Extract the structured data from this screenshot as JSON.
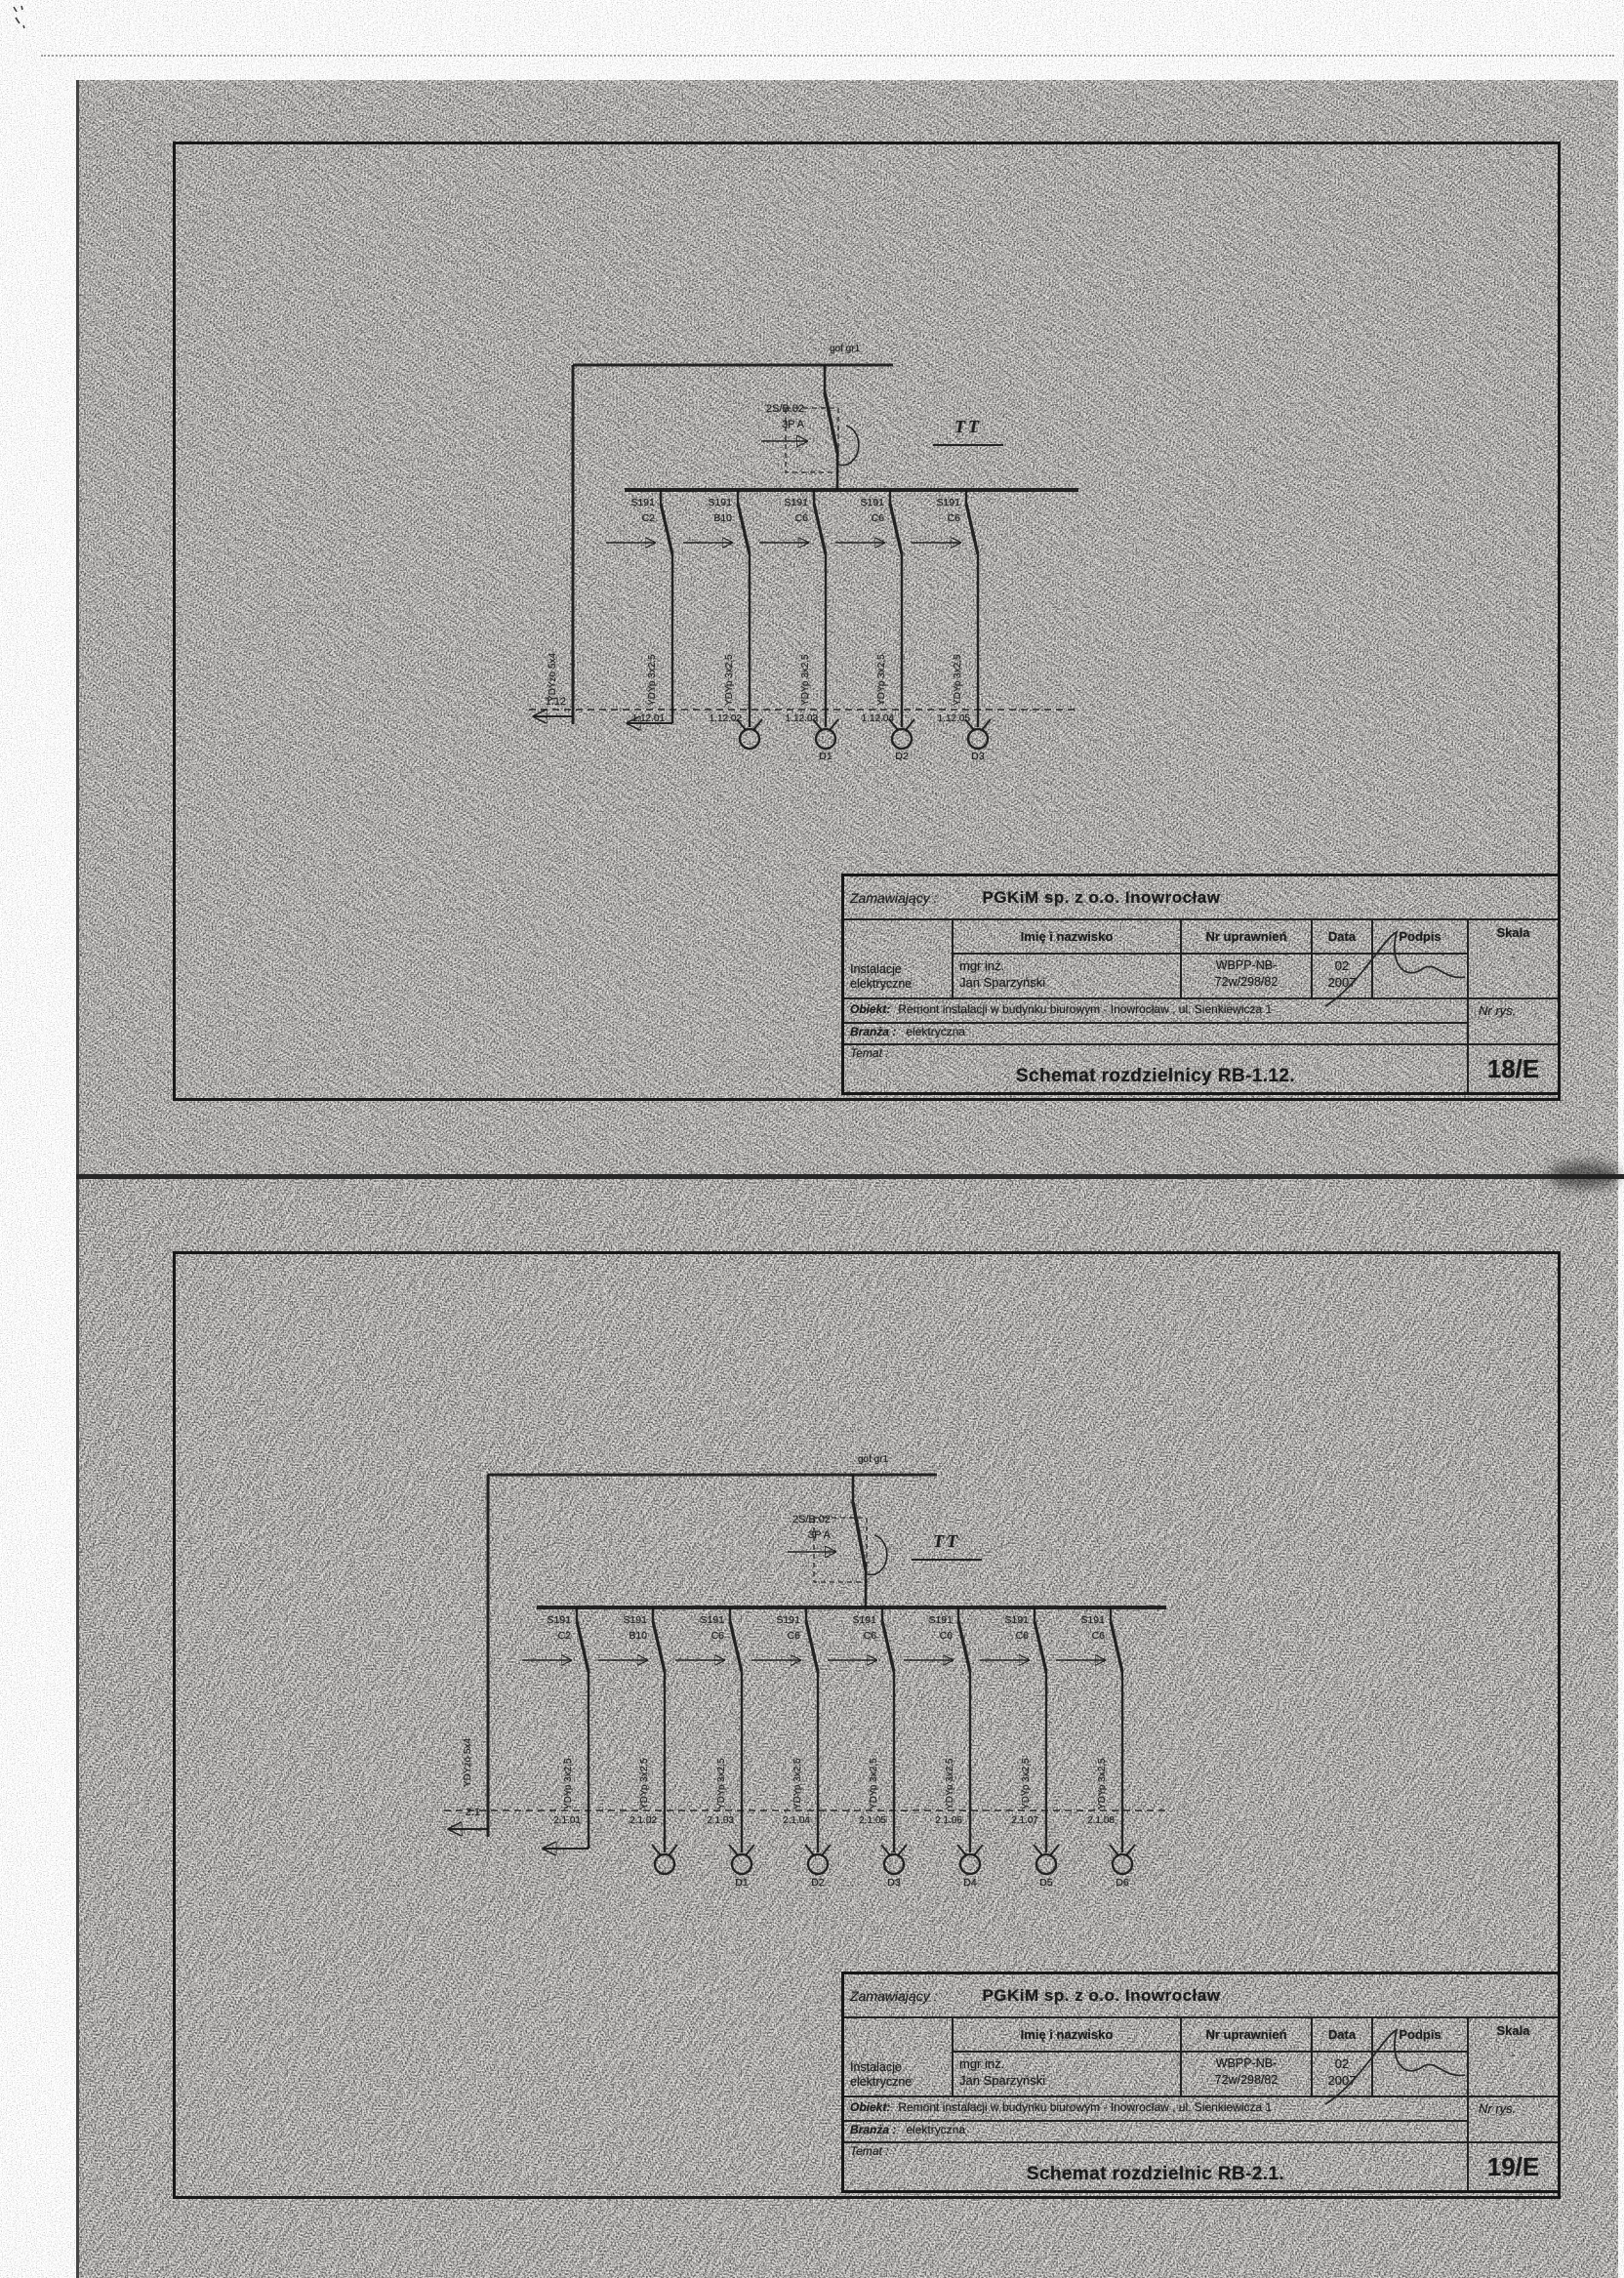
{
  "sheets": [
    {
      "name": "RB-1.12",
      "schematic": {
        "supply_label": "gof gr1",
        "system_label": "TT",
        "main_breaker_line1": "2S/B.02",
        "main_breaker_line2": "3P A",
        "riser_cable": "YDYżo 5x4",
        "riser_circuit": "1.12",
        "branches": [
          {
            "breaker": "S191",
            "rating": "C2",
            "cable": "YDYp 3x2,5",
            "circuit": "1.12.01",
            "load": ""
          },
          {
            "breaker": "S191",
            "rating": "B10",
            "cable": "YDYp 3x2,5",
            "circuit": "1.12.02",
            "load": ""
          },
          {
            "breaker": "S191",
            "rating": "C6",
            "cable": "YDYp 3x2,5",
            "circuit": "1.12.03",
            "load": "D1"
          },
          {
            "breaker": "S191",
            "rating": "C6",
            "cable": "YDYp 3x2,5",
            "circuit": "1.12.04",
            "load": "D2"
          },
          {
            "breaker": "S191",
            "rating": "C6",
            "cable": "YDYp 3x2,5",
            "circuit": "1.12.05",
            "load": "D3"
          }
        ]
      },
      "titleblock": {
        "zamawiajacy_label": "Zamawiający :",
        "zamawiajacy_value": "PGKiM sp. z o.o. Inowrocław",
        "col_name": "Imię i nazwisko",
        "col_license": "Nr uprawnień",
        "col_date": "Data",
        "col_sign": "Podpis",
        "col_scale": "Skala",
        "role_line1": "Instalacje",
        "role_line2": "elektryczne",
        "person_line1": "mgr inż.",
        "person_line2": "Jan Sparzyński",
        "license_line1": "WBPP-NB-",
        "license_line2": "72w/298/82",
        "date_line1": "02",
        "date_line2": "2007",
        "scale_value": "-",
        "obiekt_label": "Obiekt:",
        "obiekt_value": "Remont instalacji w budynku biurowym - Inowrocław , ul. Sienkiewicza 1",
        "branza_label": "Branża :",
        "branza_value": "elektryczna",
        "temat_label": "Temat :",
        "temat_value": "Schemat rozdzielnicy RB-1.12.",
        "nr_rys_label": "Nr rys.",
        "sheet_no": "18/E"
      }
    },
    {
      "name": "RB-2.1",
      "schematic": {
        "supply_label": "gof gr1",
        "system_label": "TT",
        "main_breaker_line1": "2S/B.02",
        "main_breaker_line2": "3P A",
        "riser_cable": "YDYżo 5x4",
        "riser_circuit": "2.1",
        "branches": [
          {
            "breaker": "S191",
            "rating": "C2",
            "cable": "YDYp 3x2,5",
            "circuit": "2.1.01",
            "load": ""
          },
          {
            "breaker": "S191",
            "rating": "B10",
            "cable": "YDYp 3x2,5",
            "circuit": "2.1.02",
            "load": ""
          },
          {
            "breaker": "S191",
            "rating": "C6",
            "cable": "YDYp 3x2,5",
            "circuit": "2.1.03",
            "load": "D1"
          },
          {
            "breaker": "S191",
            "rating": "C6",
            "cable": "YDYp 3x2,5",
            "circuit": "2.1.04",
            "load": "D2"
          },
          {
            "breaker": "S191",
            "rating": "C6",
            "cable": "YDYp 3x2,5",
            "circuit": "2.1.05",
            "load": "D3"
          },
          {
            "breaker": "S191",
            "rating": "C6",
            "cable": "YDYp 3x2,5",
            "circuit": "2.1.06",
            "load": "D4"
          },
          {
            "breaker": "S191",
            "rating": "C6",
            "cable": "YDYp 3x2,5",
            "circuit": "2.1.07",
            "load": "D5"
          },
          {
            "breaker": "S191",
            "rating": "C6",
            "cable": "YDYp 3x2,5",
            "circuit": "2.1.08",
            "load": "D6"
          }
        ]
      },
      "titleblock": {
        "zamawiajacy_label": "Zamawiający :",
        "zamawiajacy_value": "PGKiM sp. z o.o. Inowrocław",
        "col_name": "Imię i nazwisko",
        "col_license": "Nr uprawnień",
        "col_date": "Data",
        "col_sign": "Podpis",
        "col_scale": "Skala",
        "role_line1": "Instalacje",
        "role_line2": "elektryczne",
        "person_line1": "mgr inż.",
        "person_line2": "Jan Sparzyński",
        "license_line1": "WBPP-NB-",
        "license_line2": "72w/298/82",
        "date_line1": "02",
        "date_line2": "2007",
        "scale_value": "-",
        "obiekt_label": "Obiekt:",
        "obiekt_value": "Remont instalacji w budynku biurowym - Inowrocław , ul. Sienkiewicza 1",
        "branza_label": "Branża :",
        "branza_value": "elektryczna",
        "temat_label": "Temat :",
        "temat_value": "Schemat rozdzielnic RB-2.1.",
        "nr_rys_label": "Nr rys.",
        "sheet_no": "19/E"
      }
    }
  ]
}
